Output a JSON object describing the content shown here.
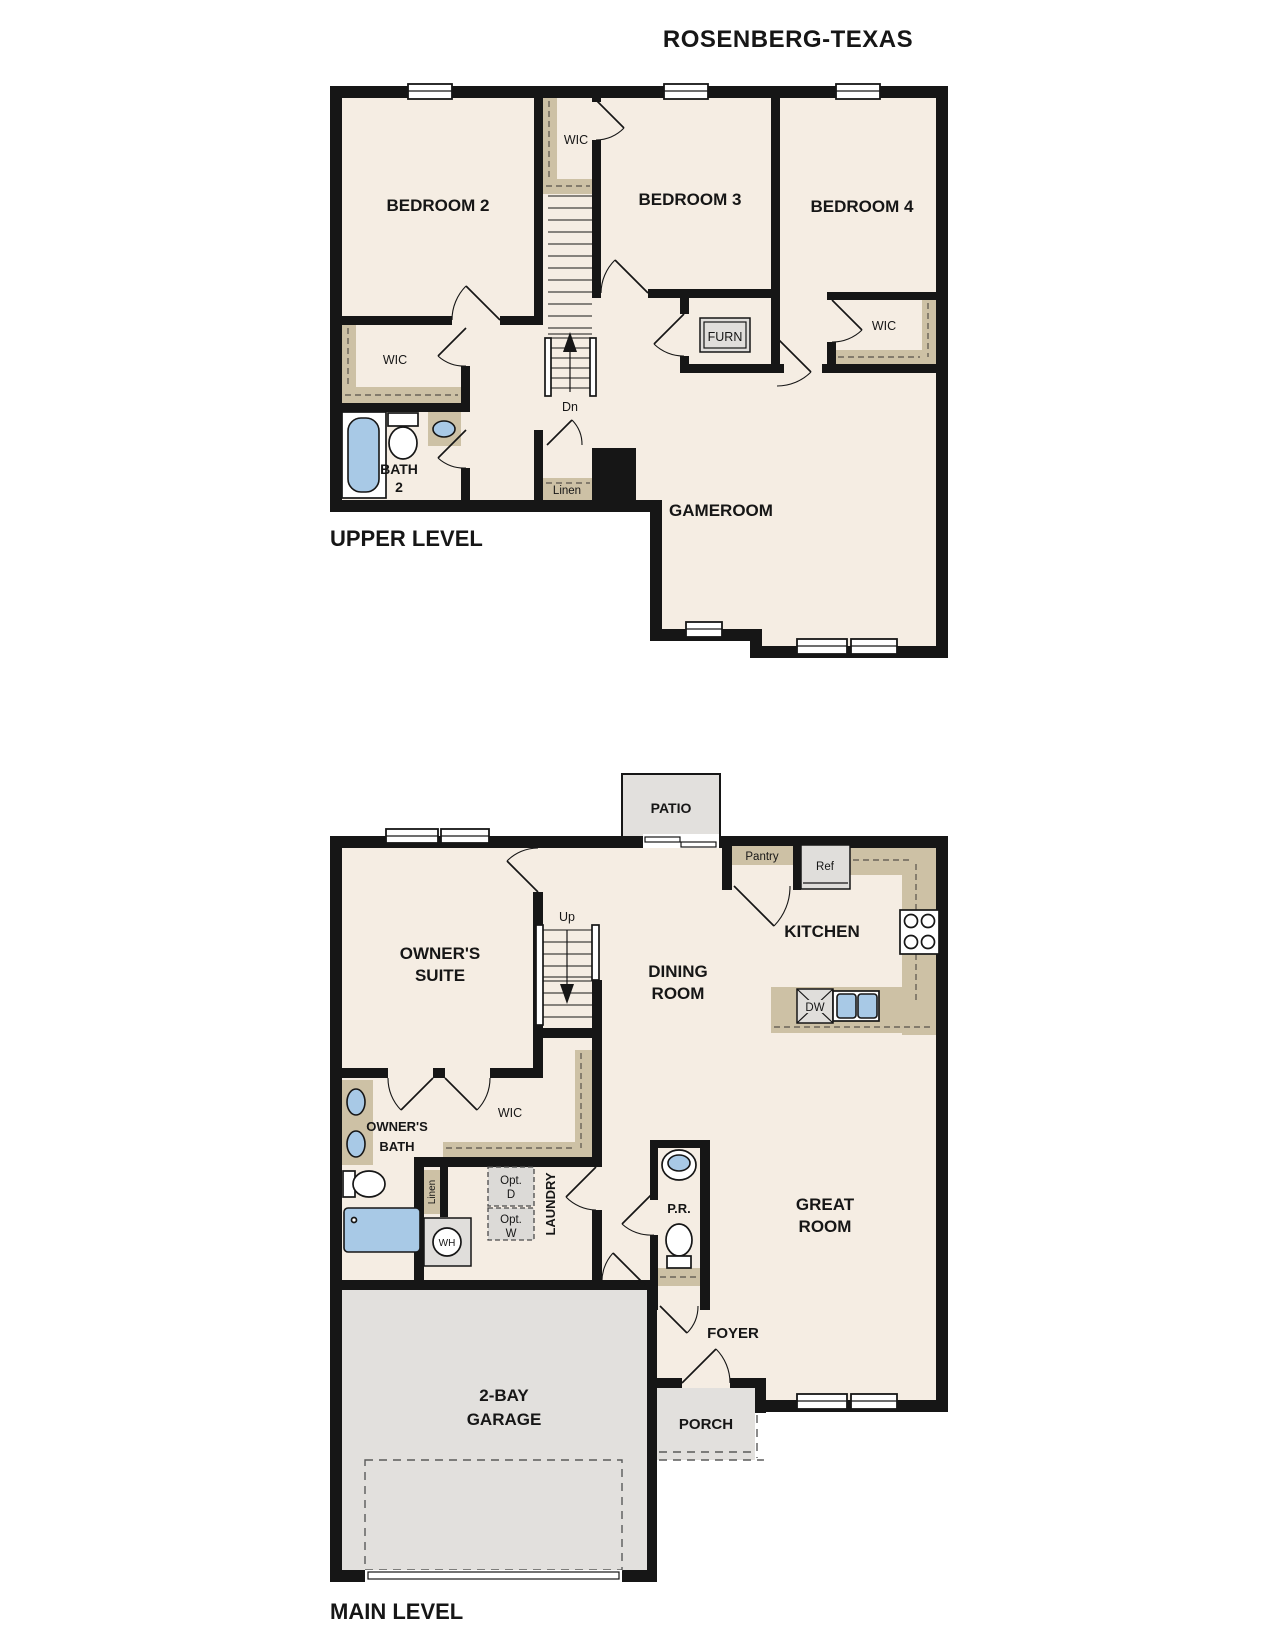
{
  "title": "ROSENBERG-TEXAS",
  "upper": {
    "level": "UPPER LEVEL",
    "bedroom2": "BEDROOM 2",
    "bedroom3": "BEDROOM 3",
    "bedroom4": "BEDROOM 4",
    "gameroom": "GAMEROOM",
    "bath_l1": "BATH",
    "bath_l2": "2",
    "wic": "WIC",
    "furn": "FURN",
    "linen": "Linen",
    "dn": "Dn"
  },
  "main": {
    "level": "MAIN LEVEL",
    "owners_l1": "OWNER'S",
    "owners_l2": "SUITE",
    "dining_l1": "DINING",
    "dining_l2": "ROOM",
    "kitchen": "KITCHEN",
    "great_l1": "GREAT",
    "great_l2": "ROOM",
    "patio": "PATIO",
    "pantry": "Pantry",
    "ref": "Ref",
    "dw": "DW",
    "wic": "WIC",
    "obath_l1": "OWNER'S",
    "obath_l2": "BATH",
    "linen": "Linen",
    "laundry": "LAUNDRY",
    "pr": "P.R.",
    "foyer": "FOYER",
    "porch": "PORCH",
    "garage_l1": "2-BAY",
    "garage_l2": "GARAGE",
    "wh": "WH",
    "optd_l1": "Opt.",
    "optd_l2": "D",
    "optw_l1": "Opt.",
    "optw_l2": "W",
    "up": "Up"
  },
  "colors": {
    "wall": "#161616",
    "floor": "#f5ede3",
    "shelf_tan": "#cdc1a5",
    "concrete_grey": "#e2e0dd",
    "fixture_blue": "#a8c9e6"
  }
}
